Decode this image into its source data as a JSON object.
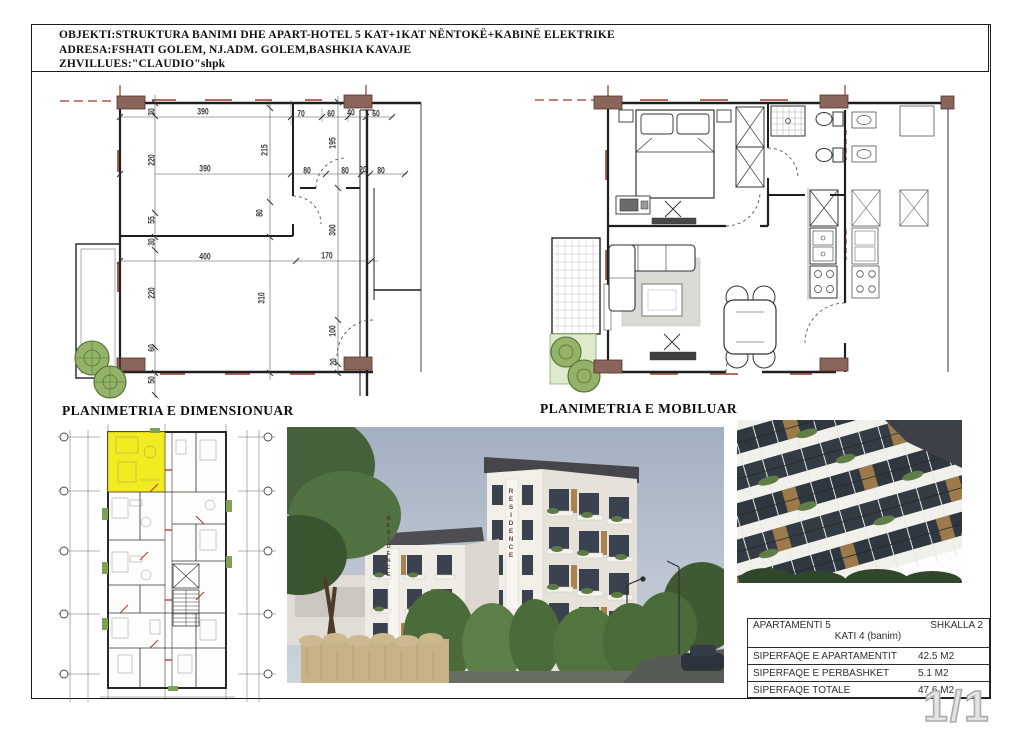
{
  "document": {
    "page_number": "1/1",
    "header": {
      "line1": "OBJEKTI:STRUKTURA BANIMI DHE APART-HOTEL 5 KAT+1KAT NËNTOKË+KABINË ELEKTRIKE",
      "line2": "ADRESA:FSHATI GOLEM, NJ.ADM. GOLEM,BASHKIA KAVAJE",
      "line3": "ZHVILLUES:\"CLAUDIO\"shpk"
    }
  },
  "plans": {
    "dimensioned": {
      "title": "PLANIMETRIA E DIMENSIONUAR",
      "dimension_labels": [
        "30",
        "390",
        "70",
        "60",
        "40",
        "60",
        "220",
        "390",
        "215",
        "195",
        "80",
        "80",
        "20",
        "80",
        "80",
        "55",
        "30",
        "400",
        "170",
        "220",
        "310",
        "300",
        "100",
        "60",
        "20",
        "50"
      ]
    },
    "furnished": {
      "title": "PLANIMETRIA E MOBILUAR"
    }
  },
  "key_plan": {
    "highlighted_unit": "APARTAMENTI 5",
    "highlight_color": "#f2ea16"
  },
  "renders": {
    "building_sign_vertical": "RESIDENCE"
  },
  "summary_table": {
    "apartment": "APARTAMENTI 5",
    "staircase": "SHKALLA 2",
    "floor": "KATI 4 (banim)",
    "rows": [
      {
        "label": "SIPERFAQE E APARTAMENTIT",
        "value": "42.5 M2"
      },
      {
        "label": "SIPERFAQE E PERBASHKET",
        "value": "5.1 M2"
      },
      {
        "label": "SIPERFAQE TOTALE",
        "value": "47.6 M2"
      }
    ]
  },
  "colors": {
    "highlight_yellow": "#f2ea16",
    "column_maroon": "#8a655c",
    "axis_red": "#9a3a2c",
    "vegetation_green": "#94b269",
    "sky_blue_gray": "#a9b4c4",
    "roof_dark": "#4a4a4e",
    "hedge_tan": "#c7b288"
  }
}
